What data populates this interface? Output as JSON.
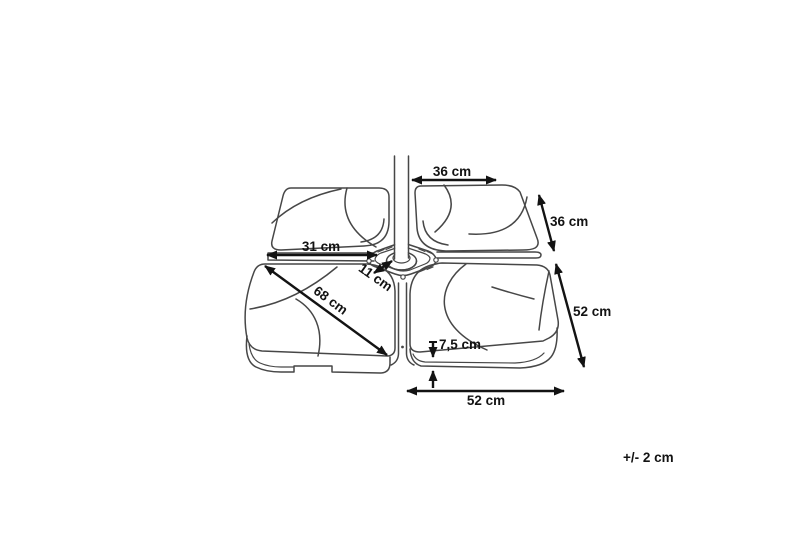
{
  "diagram": {
    "subject": "parasol-weight-base-dimension-drawing",
    "tolerance_note": "+/- 2 cm",
    "dimensions": [
      {
        "id": "top-width",
        "label": "36 cm"
      },
      {
        "id": "right-upper-depth",
        "label": "36 cm"
      },
      {
        "id": "left-width",
        "label": "31 cm"
      },
      {
        "id": "hub-width",
        "label": "11 cm"
      },
      {
        "id": "diagonal",
        "label": "68 cm"
      },
      {
        "id": "right-lower-depth",
        "label": "52 cm"
      },
      {
        "id": "plate-height",
        "label": "7,5 cm"
      },
      {
        "id": "bottom-width",
        "label": "52 cm"
      }
    ],
    "colors": {
      "background": "#ffffff",
      "line": "#474747",
      "annotation": "#131313"
    }
  }
}
